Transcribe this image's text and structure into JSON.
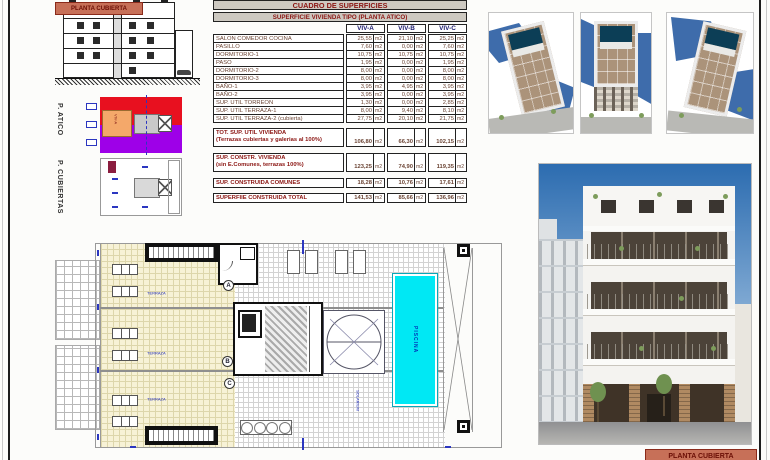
{
  "labels": {
    "planta_cubierta_top": "PLANTA CUBIERTA",
    "planta_cubierta_bottom": "PLANTA CUBIERTA",
    "p_atico": "P. ATICO",
    "p_cubiertas": "P. CUBIERTAS",
    "atico_viv_a": "VIV-A"
  },
  "table": {
    "title": "CUADRO DE SUPERFICIES",
    "subtitle": "SUPERFICIE VIVIENDA TIPO  (PLANTA ATICO)",
    "unit": "m2",
    "columns": [
      "VIV-A",
      "VIV-B",
      "VIV-C"
    ],
    "rows": [
      {
        "label": "SALON COMEDOR COCINA",
        "values": [
          "25,55",
          "21,10",
          "25,25"
        ]
      },
      {
        "label": "PASILLO",
        "values": [
          "7,60",
          "0,00",
          "7,60"
        ]
      },
      {
        "label": "DORMITORIO-1",
        "values": [
          "10,75",
          "10,75",
          "10,75"
        ]
      },
      {
        "label": "PASO",
        "values": [
          "1,95",
          "0,00",
          "1,95"
        ]
      },
      {
        "label": "DORMITORIO-2",
        "values": [
          "8,00",
          "0,00",
          "8,00"
        ]
      },
      {
        "label": "DORMITORIO-3",
        "values": [
          "8,00",
          "0,00",
          "8,00"
        ]
      },
      {
        "label": "BAÑO-1",
        "values": [
          "3,95",
          "4,95",
          "3,95"
        ]
      },
      {
        "label": "BAÑO-2",
        "values": [
          "3,95",
          "0,00",
          "3,95"
        ]
      },
      {
        "label": "SUP. UTIL TORREON",
        "values": [
          "1,30",
          "0,00",
          "2,85"
        ]
      },
      {
        "label": "SUP. UTIL TERRAZA-1",
        "values": [
          "8,00",
          "9,40",
          "8,10"
        ]
      },
      {
        "label": "SUP. UTIL TERRAZA-2 (cubierta)",
        "values": [
          "27,75",
          "20,10",
          "21,75"
        ]
      }
    ],
    "summary": [
      {
        "label": "TOT. SUP. UTIL VIVIENDA",
        "sublabel": "(Terrazas cubiertas y galerias al 100%)",
        "values": [
          "106,80",
          "66,30",
          "102,15"
        ]
      },
      {
        "label": "SUP. CONSTR. VIVIENDA",
        "sublabel": "(sin E.Comunes, terrazas 100%)",
        "values": [
          "123,25",
          "74,90",
          "119,35"
        ]
      },
      {
        "label": "SUP. CONSTRUIDA COMUNES",
        "sublabel": "",
        "values": [
          "18,28",
          "10,76",
          "17,61"
        ]
      },
      {
        "label": "SUPERFIIE CONSTRUIDA TOTAL",
        "sublabel": "",
        "values": [
          "141,53",
          "85,66",
          "136,96"
        ]
      }
    ]
  },
  "roof_plan": {
    "markers": {
      "a": "A",
      "b": "B",
      "c": "C"
    },
    "pool_label": "PISCINA",
    "terrace_label": "TERRAZA",
    "solarium_label": "SOLARIUM"
  },
  "colors": {
    "accent_salmon": "#c77058",
    "label_red": "#6b0f06",
    "table_title_red": "#8b1512",
    "header_navy": "#1a1a6e",
    "plan_red": "#e8101f",
    "plan_purple": "#9e00e8",
    "plan_orange": "#f4a86a",
    "pool_cyan": "#00e8f4",
    "annotation_blue": "#2b36c0"
  }
}
